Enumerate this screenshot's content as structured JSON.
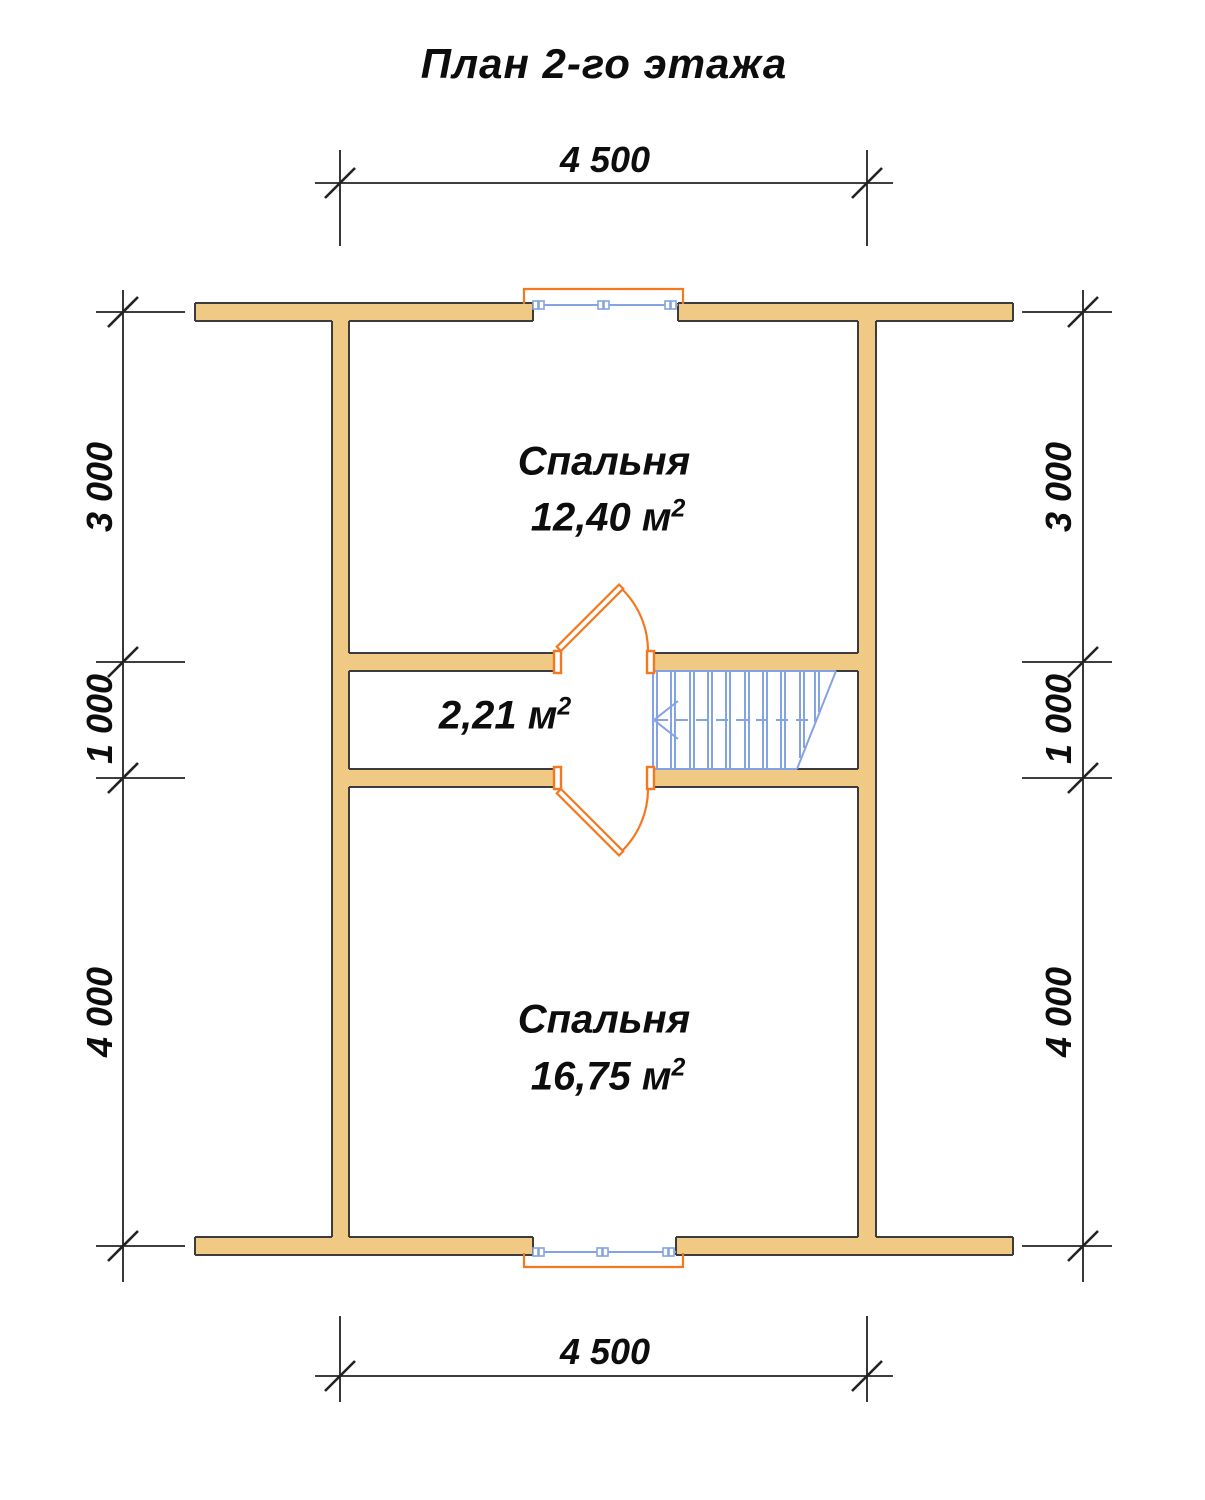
{
  "title": "План 2-го этажа",
  "dimensions": {
    "top": "4 500",
    "bottom": "4 500",
    "left": [
      "3 000",
      "1 000",
      "4 000"
    ],
    "right": [
      "3 000",
      "1 000",
      "4 000"
    ]
  },
  "rooms": {
    "bedroom_top": {
      "name": "Спальня",
      "area": "12,40 м",
      "area_sup": "2"
    },
    "hall": {
      "area": "2,21 м",
      "area_sup": "2"
    },
    "bedroom_bottom": {
      "name": "Спальня",
      "area": "16,75 м",
      "area_sup": "2"
    }
  },
  "colors": {
    "wall_fill": "#f0ca84",
    "wall_outline": "#3c3c3c",
    "door_window_frame": "#f5781e",
    "window_glass_and_stairs": "#84a3e4",
    "dimension_lines": "#222222",
    "text": "#0d0d0d"
  }
}
